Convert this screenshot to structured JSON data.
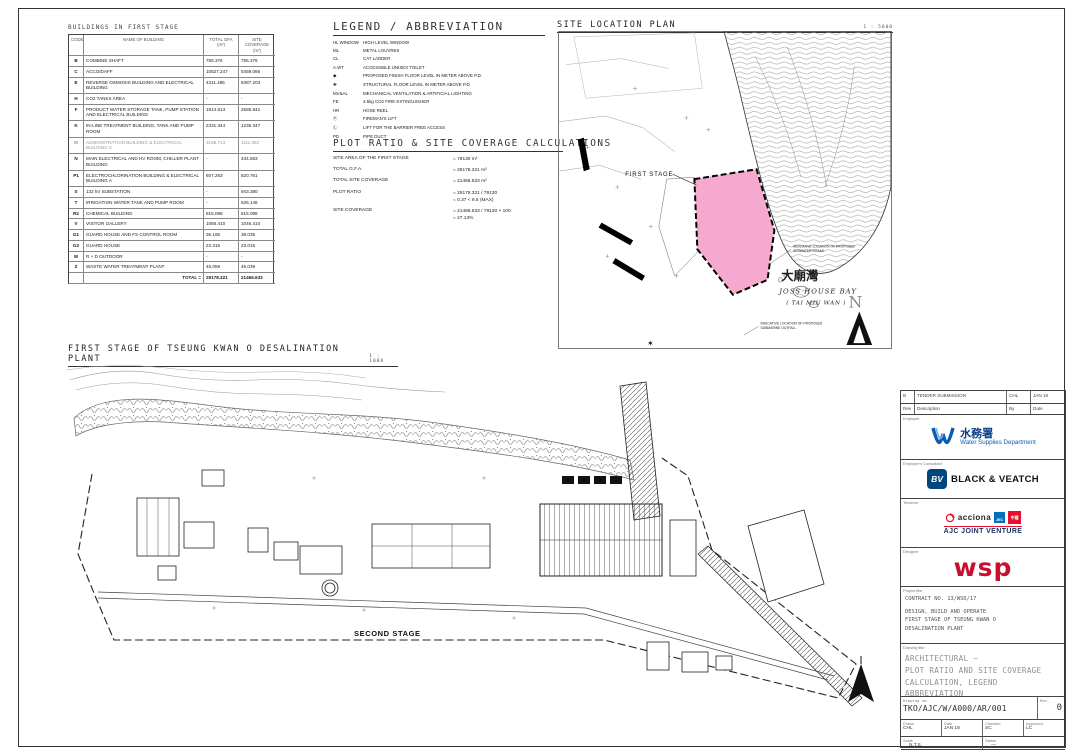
{
  "buildings_table": {
    "title": "BUILDINGS IN FIRST STAGE",
    "columns": [
      "CODE",
      "NAME OF BUILDING",
      "TOTAL GFA (m²)",
      "SITE COVERAGE (m²)"
    ],
    "rows": [
      {
        "code": "B",
        "name": "COMBINE SHAFT",
        "gfa": "755.376",
        "coverage": "755.376"
      },
      {
        "code": "C",
        "name": "ACCO/DAFF",
        "gfa": "10527.247",
        "coverage": "5459.086"
      },
      {
        "code": "E",
        "name": "REVERSE OSMOSIS BUILDING AND ELECTRICAL BUILDING",
        "gfa": "4311.485",
        "coverage": "6387.203"
      },
      {
        "code": "H",
        "name": "CO2 TANKS AREA",
        "gfa": "-",
        "coverage": "-"
      },
      {
        "code": "F",
        "name": "PRODUCT WATER STORAGE TANK, PUMP STATION AND ELECTRICAL BUILDING",
        "gfa": "1914.813",
        "coverage": "2585.841"
      },
      {
        "code": "K",
        "name": "IN-LINE TREATMENT BUILDING, TANK AND PUMP ROOM",
        "gfa": "2331.344",
        "coverage": "1235.347"
      },
      {
        "code": "M",
        "name": "ADMINISTRATION BUILDING & ELECTRICAL BUILDING C",
        "gfa": "3166.713",
        "coverage": "1111.062"
      },
      {
        "code": "N",
        "name": "MAIN ELECTRICAL AND HV ROOM, CHILLER PLANT BUILDING",
        "gfa": "-",
        "coverage": "434.563"
      },
      {
        "code": "P1",
        "name": "ELECTROCHLORINATION BUILDING & ELECTRICAL BUILDING A",
        "gfa": "607.263",
        "coverage": "820.761"
      },
      {
        "code": "S",
        "name": "132 kV SUBSTATION",
        "gfa": "-",
        "coverage": "943.380"
      },
      {
        "code": "T",
        "name": "IRRIGATION WATER TANK AND PUMP ROOM",
        "gfa": "-",
        "coverage": "526.148"
      },
      {
        "code": "R2",
        "name": "CHEMICAL BUILDING",
        "gfa": "815.098",
        "coverage": "815.098"
      },
      {
        "code": "V",
        "name": "VISITOR GALLERY",
        "gfa": "1066.410",
        "coverage": "1046.410"
      },
      {
        "code": "G1",
        "name": "GUARD HOUSE AND FS CONTROL ROOM",
        "gfa": "35.185",
        "coverage": "38.035"
      },
      {
        "code": "G2",
        "name": "GUARD HOUSE",
        "gfa": "22.315",
        "coverage": "23.015"
      },
      {
        "code": "W",
        "name": "R + D OUTDOOR",
        "gfa": "-",
        "coverage": "-"
      },
      {
        "code": "Z",
        "name": "WASTE WATER TREATMENT PLANT",
        "gfa": "45.059",
        "coverage": "46.039"
      }
    ],
    "total_label": "TOTAL =",
    "total_gfa": "29178.321",
    "total_coverage": "21466.633"
  },
  "legend": {
    "title": "LEGEND / ABBREVIATION",
    "items": [
      {
        "sym": "HL WINDOW",
        "desc": "HIGH LEVEL WINDOW"
      },
      {
        "sym": "ML",
        "desc": "METAL LOUVRES"
      },
      {
        "sym": "CL",
        "desc": "CAT LADDER"
      },
      {
        "sym": "A.WT",
        "desc": "ACCESSIBLE UNISEX TOILET"
      },
      {
        "sym": "◆",
        "desc": "PROPOSED FINISH FLOOR LEVEL IN METER ABOVE P.D."
      },
      {
        "sym": "✚",
        "desc": "STRUCTURAL FLOOR LEVEL IN METER ABOVE P.D."
      },
      {
        "sym": "MV&AL",
        "desc": "MECHANICAL VENTILATION & ARTIFICIAL LIGHTING"
      },
      {
        "sym": "FE",
        "desc": "4.5kg CO2 FIRE EXTINGUISHER"
      },
      {
        "sym": "HR",
        "desc": "HOSE REEL"
      },
      {
        "sym": "Ⓕ",
        "desc": "FIREMAN'S LIFT"
      },
      {
        "sym": "Ⓛ",
        "desc": "LIFT FOR THE BARRIER FREE ACCESS"
      },
      {
        "sym": "PD",
        "desc": "PIPE DUCT"
      }
    ]
  },
  "plot_ratio": {
    "title": "PLOT RATIO & SITE COVERAGE CALCULATIONS",
    "lines": [
      {
        "label": "SITE AREA OF THE FIRST STAGE",
        "value": "=  79130 m²"
      },
      {
        "label": "TOTAL G.F.A.",
        "value": "=  29178.321 m²"
      },
      {
        "label": "TOTAL SITE COVERAGE",
        "value": "=  21466.633 m²"
      },
      {
        "label": "PLOT RATIO",
        "value": "=  29178.321 / 79130",
        "value2": "=  0.37  <  9.5 (MAX)"
      },
      {
        "label": "SITE COVERAGE",
        "value": "=  21466.633 / 79130 × 100",
        "value2": "=  27.13%"
      }
    ]
  },
  "location_plan": {
    "title": "SITE LOCATION PLAN",
    "scale": "1 : 5000",
    "first_stage_label": "FIRST STAGE",
    "bay_name_zh": "大廟灣",
    "bay_name_en": "JOSS HOUSE BAY",
    "bay_name_sub": "( TAI MIU WAN )",
    "intake_note_1": "INDICATIVE LOCATION OF PROPOSED",
    "intake_note_2": "SEAWATER INTAKE",
    "outfall_note_1": "INDICATIVE LOCATION OF PROPOSED",
    "outfall_note_2": "SUBMARINE OUTFALL",
    "north_label": "N",
    "first_stage_color": "#f5a9cf"
  },
  "main_plan": {
    "title": "FIRST STAGE OF TSEUNG KWAN O DESALINATION PLANT",
    "scale": "1 : 1000",
    "second_stage_label": "SECOND STAGE"
  },
  "title_block": {
    "rev_row": {
      "rev": "B",
      "description": "TENDER SUBMISSION",
      "by": "CHL",
      "date": "JAN 18"
    },
    "rev_header": {
      "rev": "Rev",
      "description": "Description",
      "by": "By",
      "date": "Date"
    },
    "employer_label": "Employer",
    "employer_zh": "水務署",
    "employer_en": "Water Supplies Department",
    "consultant_label": "Employer's Consultant",
    "consultant_bv": "BV",
    "consultant_name": "BLACK & VEATCH",
    "tenderer_label": "Tenderer",
    "tenderer_acciona": "acciona",
    "tenderer_jec": "JEC",
    "tenderer_cs": "中建",
    "tenderer_name": "AJC JOINT VENTURE",
    "designer_label": "Designer",
    "designer_name": "wsp",
    "project_label": "Project title",
    "project_lines": [
      "CONTRACT NO. 13/WSD/17",
      "DESIGN, BUILD AND OPERATE",
      "FIRST STAGE OF TSEUNG KWAN O",
      "DESALINATION PLANT"
    ],
    "drawing_label": "Drawing title",
    "drawing_lines": [
      "ARCHITECTURAL —",
      "PLOT RATIO AND SITE COVERAGE",
      "CALCULATION, LEGEND",
      "ABBREVIATION"
    ],
    "drawing_no_label": "Drawing no.",
    "drawing_no": "TKO/AJC/W/A000/AR/001",
    "rev_label": "Rev.",
    "rev_value": "0",
    "drawn_label": "Drawn",
    "drawn": "CHL",
    "date_label": "Date",
    "date": "JAN 18",
    "checked_label": "Checked",
    "checked": "SC",
    "approved_label": "Approved",
    "approved": "LC",
    "scale_label": "Scale",
    "scale": "N.T.S.",
    "status_label": "Status",
    "status": "—",
    "copyright": "©COPYRIGHT RESERVED",
    "colors": {
      "wsd_blue": "#0a5bb5",
      "bv_blue": "#00477d",
      "jec_blue": "#0072bc",
      "red": "#e8112d",
      "wsp_red": "#c8102e",
      "navy": "#1b2f5e"
    }
  }
}
